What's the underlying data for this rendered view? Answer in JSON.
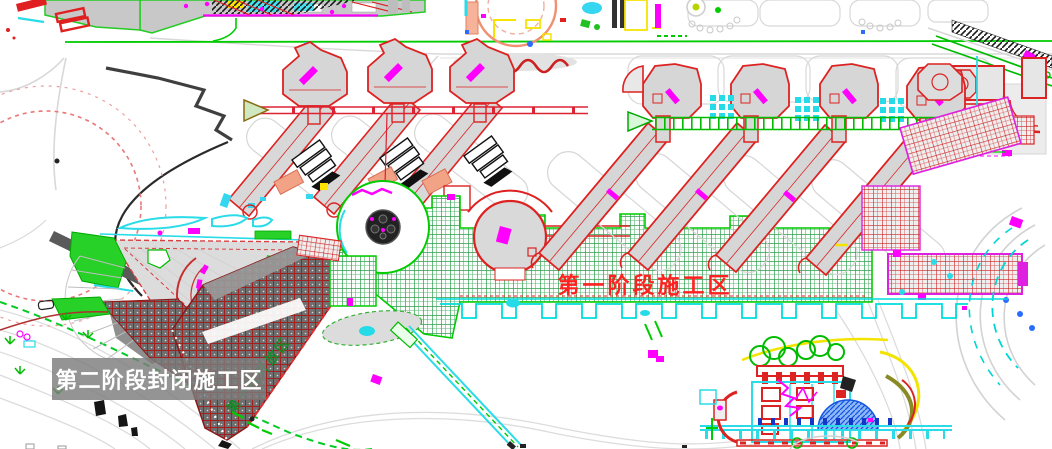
{
  "labels": {
    "phase2_closed_zone": "第二阶段封闭施工区",
    "phase1_construction_zone": "第一阶段施工区",
    "phase1_open_zone": "第一批开放区"
  },
  "colors": {
    "background": "#ffffff",
    "road_gray": "#d8d8d8",
    "cad_green_line": "#00cc00",
    "plaza_grid_green": "#2f9e50",
    "building_outline_red": "#dd2222",
    "phase2_hatch_red": "#a32020",
    "hatch_band_magenta": "#e020e0",
    "magenta_marks": "#ff00ff",
    "cyan_lines": "#2adbe8",
    "salmon_block": "#f2a285",
    "yellow_marks": "#f5e400",
    "blue_hatch": "#1456e0",
    "black_hatch": "#1a1a1a",
    "label_box_background": "rgba(125,125,125,0.82)",
    "label_box_text": "#ffffff",
    "phase1_text_red": "#ff2020",
    "phase1_open_text_green": "#158a2a"
  }
}
